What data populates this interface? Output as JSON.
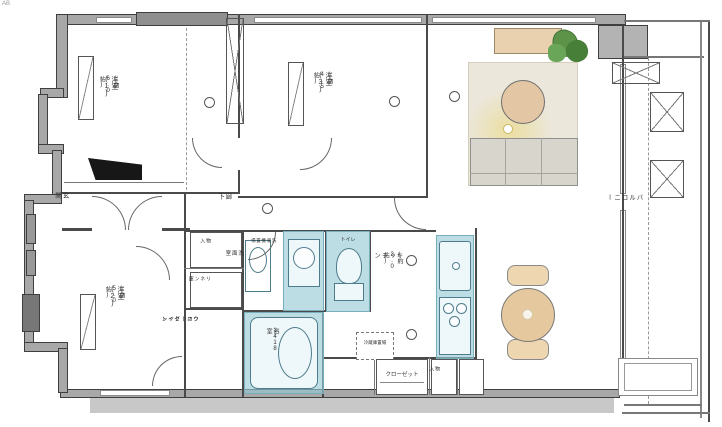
{
  "meta": {
    "corner_note": "AB"
  },
  "rooms": {
    "bedroom1": {
      "name": "洋室(1)",
      "size": "(約6.0帖)"
    },
    "bedroom3": {
      "name": "洋室(3)",
      "size": "(約4.5帖)"
    },
    "bedroom2": {
      "name": "洋室(2)",
      "size": "(約5.0帖)"
    },
    "kitchen": {
      "name": "キッチン",
      "size": "(約3.0帖)"
    },
    "bath": {
      "name": "浴室",
      "size": "1418"
    },
    "washroom": {
      "name": "洗面室"
    },
    "laundry": {
      "name": "洗濯機置場"
    },
    "toilet": {
      "name": "トイレ"
    },
    "hallway": {
      "name": "廊下"
    },
    "entrance": {
      "name": "玄関"
    },
    "balcony": {
      "name": "バルコニー"
    },
    "wic": {
      "line1": "ウォークイン",
      "line2": "クローゼット"
    },
    "storage_top": {
      "name": "物入"
    },
    "linen": {
      "name": "リネン庫"
    },
    "closet": {
      "name": "クローゼット"
    },
    "storage_band": {
      "name": "物入"
    },
    "fridge": {
      "name": "冷蔵庫置場"
    }
  },
  "colors": {
    "wet_area": "#94c8d5",
    "wood": "#e5c89d",
    "rug": "#ebe7db",
    "plant": "#5c9349",
    "lamp_glow": "#ecd66e",
    "wall": "#a8a8a8"
  }
}
